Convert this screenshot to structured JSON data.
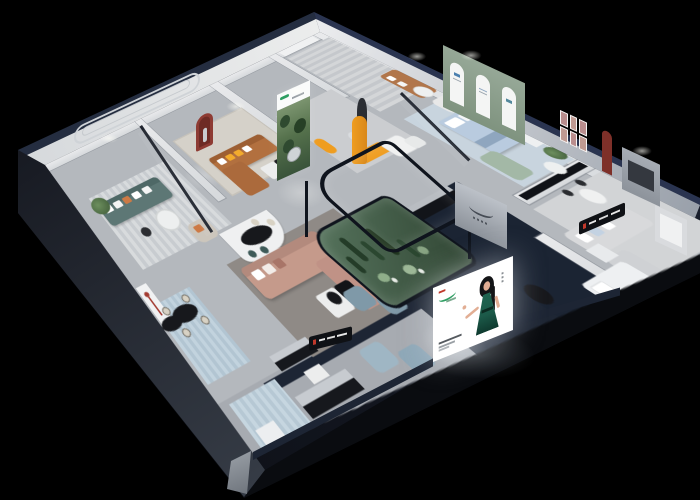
{
  "scene": {
    "type": "isometric-cutaway-showroom-render",
    "background": "#000000",
    "projection": "axonometric-with-perspective"
  },
  "palette": {
    "bg": "#000000",
    "shellDark": "#11141c",
    "shellSkirtTop": "#1c2028",
    "shellSkirtBottom": "#343a44",
    "wallTopNavy": "#242d40",
    "wallTopNavyNE": "#2a3450",
    "wallFace": "#e9eaec",
    "wallFaceFar": "#99a0aa",
    "floor": "#b4b8bd",
    "floorDark": "#a7abb1",
    "navyZone": "#1b2433",
    "navyLip": "#1d2534",
    "teal": "#5d7775",
    "tealDark": "#4e6866",
    "caramel": "#b2703f",
    "caramelDark": "#9d5f33",
    "caramelLight": "#b1764b",
    "rose": "#c59a8b",
    "roseDark": "#b38a7d",
    "graySofa": "#d8d9db",
    "bedBlue": "#b9cbdf",
    "bedThrow": "#8fa6bf",
    "sageSeat": "#a3b8a6",
    "blueChair": "#7f99a8",
    "ottomanBlue": "#9fb6c4",
    "orange": "#ef9d20",
    "orangeThrow": "#cd7a45",
    "yellowPillow": "#f2ab2d",
    "plantGreen": "#4c6b45",
    "atriumA": "#57755e",
    "atriumB": "#314634",
    "cactus": "#243c28",
    "blackFurn": "#17181c",
    "silver": "#c7cbd0",
    "cream": "#d8d2c4",
    "redAccent": "#8e3b33",
    "redArchB": "#7e3029",
    "sageWall": "#8da08f",
    "rugBlue": "#c2d3de",
    "rugTaupe": "#8f8a86",
    "rugBeige": "#d5d1c9",
    "white": "#f1f2f3",
    "posterGreen": "#2e9e62",
    "posterRed": "#c0392b",
    "dressGreen": "#1c5a49",
    "skin": "#e2ae94",
    "hair": "#141517",
    "signBlack": "#0f1115",
    "glass": "#10151f"
  },
  "billboard": {
    "figure": "woman-in-green-dress",
    "background": "#ffffff",
    "logo_color": "#2e9e62",
    "text_lines": 3
  },
  "wall_art": {
    "forest_mural": "green-forest-artwork",
    "arched_wall_panels": 3,
    "picture_frames_grid": {
      "rows": 2,
      "cols": 3
    },
    "red_arch_niches": 2,
    "brand_plaque": "cursive-logo-wall"
  },
  "rooms": [
    {
      "id": "teal-lounge",
      "items": [
        "teal-sofa",
        "round-coffee-table",
        "armchair",
        "potted-plant",
        "striped-rug",
        "molding-wall"
      ]
    },
    {
      "id": "caramel-lounge",
      "items": [
        "caramel-sectional",
        "coffee-table",
        "red-arch-niche",
        "glass-partition",
        "plant"
      ]
    },
    {
      "id": "gallery-walk",
      "items": [
        "forest-mural",
        "statue-pedestal",
        "orange-bench",
        "orange-chair",
        "nesting-tables"
      ]
    },
    {
      "id": "north-booth",
      "items": [
        "caramel-loveseat",
        "white-armchair",
        "round-table",
        "sage-arch-wall",
        "sideboard"
      ]
    },
    {
      "id": "bedroom",
      "items": [
        "blue-bed",
        "green-loveseat",
        "wardrobe",
        "plant",
        "glass-partition"
      ]
    },
    {
      "id": "right-lounge",
      "items": [
        "gray-sofa-set",
        "dining-table",
        "picture-frames",
        "tv-panel",
        "media-rail"
      ]
    },
    {
      "id": "front-right-room",
      "items": [
        "white-bed",
        "black-round-table",
        "cabinet"
      ]
    },
    {
      "id": "center",
      "items": [
        "cactus-atrium",
        "rose-sectional",
        "two-tone-coffee-table",
        "navy-platform",
        "black-console"
      ]
    },
    {
      "id": "bar-area",
      "items": [
        "black-oval-table",
        "cream-stools",
        "display-shelf",
        "red-floor-lamp",
        "blue-rugs",
        "benches",
        "ottomans"
      ]
    }
  ]
}
